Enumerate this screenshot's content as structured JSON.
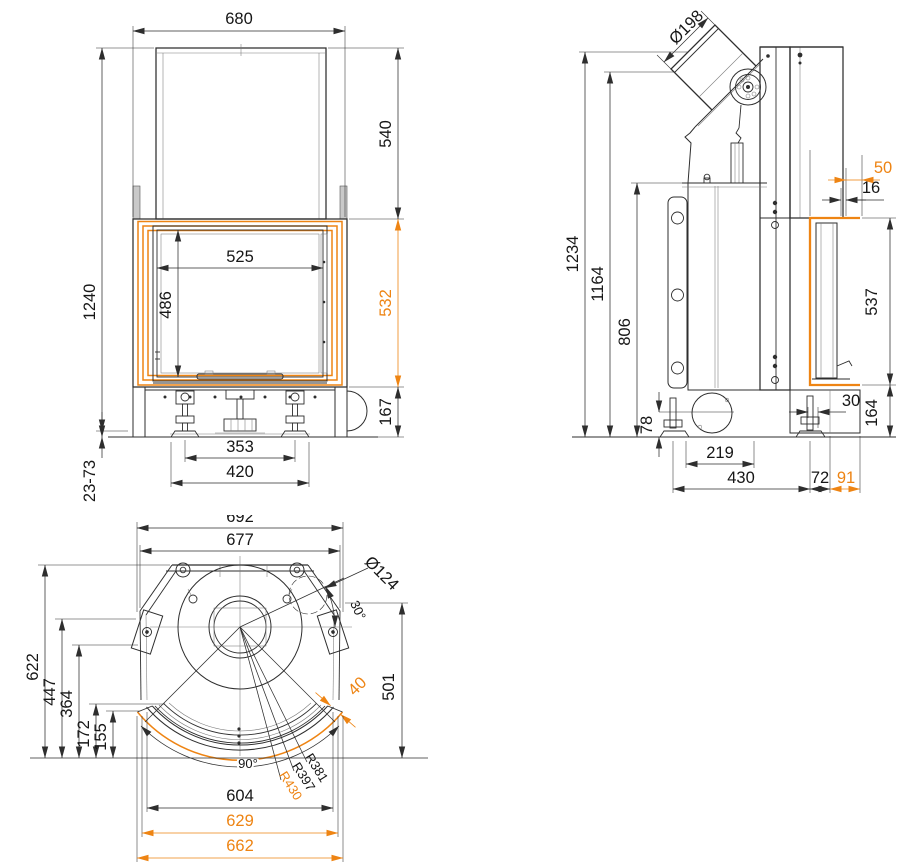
{
  "document": {
    "type": "technical-drawing",
    "subject": "fireplace-insert three-view dimensional drawing",
    "units": "mm",
    "colors": {
      "line": "#2e2e2e",
      "accent_dimension": "#ee8413",
      "background": "#ffffff"
    }
  },
  "views": {
    "front": {
      "label": "front-view",
      "dims": {
        "width_overall": "680",
        "hood_height": "540",
        "glass_width": "525",
        "glass_height": "486",
        "height_overall": "1240",
        "frame_height": "532",
        "base_height": "167",
        "feet_centers": "353",
        "feet_outer": "420",
        "leveling_range": "23-73"
      }
    },
    "side": {
      "label": "side-view",
      "dims": {
        "flue_diameter": "Ø198",
        "frame_offset": "50",
        "glass_offset": "16",
        "height_overall": "1234",
        "height_flue_mouth": "1164",
        "height_firebox_top": "806",
        "door_height": "537",
        "foot_offset": "30",
        "front_base_height": "164",
        "intake_axis_height": "78",
        "base_inner_depth": "219",
        "base_depth": "430",
        "mid_depth": "72",
        "frame_depth": "91"
      }
    },
    "plan": {
      "label": "plan-view",
      "dims": {
        "width_overall": "692",
        "width_inner": "677",
        "connector_diameter": "Ø124",
        "connector_angle": "30°",
        "depth_overall": "622",
        "depth_bracket": "447",
        "depth_center": "364",
        "depth_front_inner": "172",
        "depth_front_outer": "155",
        "depth_right": "501",
        "band_width": "40",
        "arc_angle": "90°",
        "radius_inner": "R381",
        "radius_mid": "R397",
        "radius_outer": "R430",
        "front_inner": "604",
        "front_mid": "629",
        "front_outer": "662"
      }
    }
  }
}
